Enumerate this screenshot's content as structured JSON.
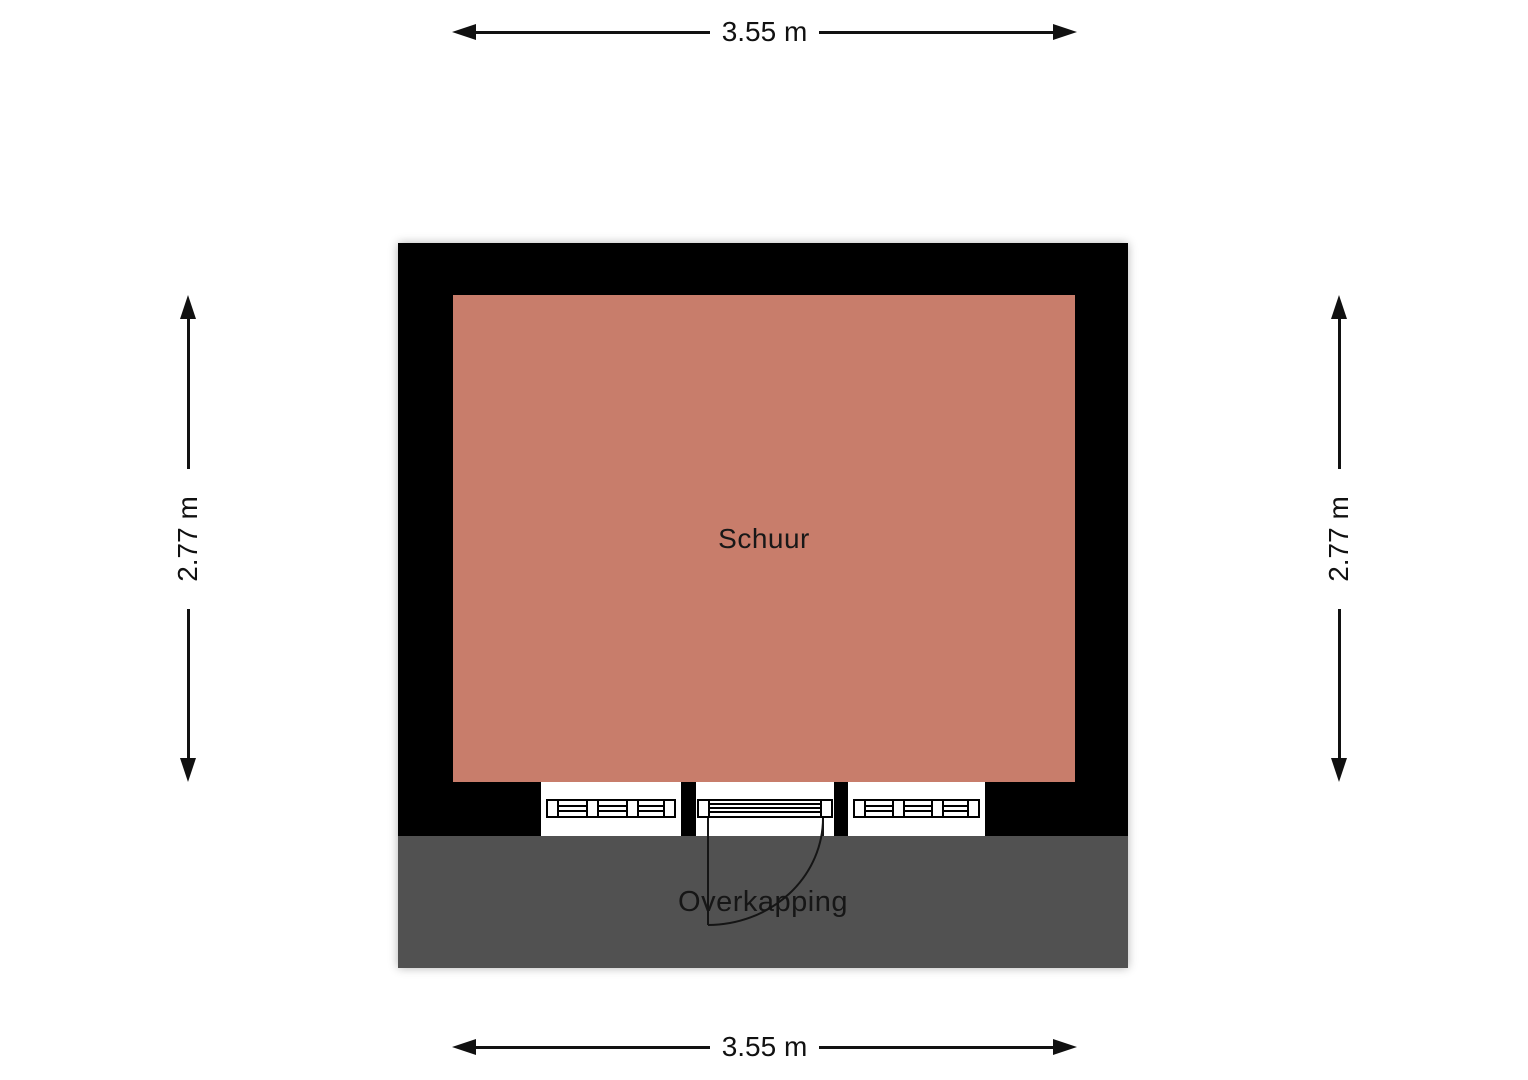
{
  "plan": {
    "room": {
      "label": "Schuur"
    },
    "canopy": {
      "label": "Overkapping"
    },
    "colors": {
      "wall": "#000000",
      "floor": "#c87d6b",
      "canopy": "#515151",
      "dimension": "#111111"
    }
  },
  "dimensions": {
    "top": {
      "label": "3.55 m"
    },
    "bottom": {
      "label": "3.55 m"
    },
    "left": {
      "label": "2.77 m"
    },
    "right": {
      "label": "2.77 m"
    }
  }
}
